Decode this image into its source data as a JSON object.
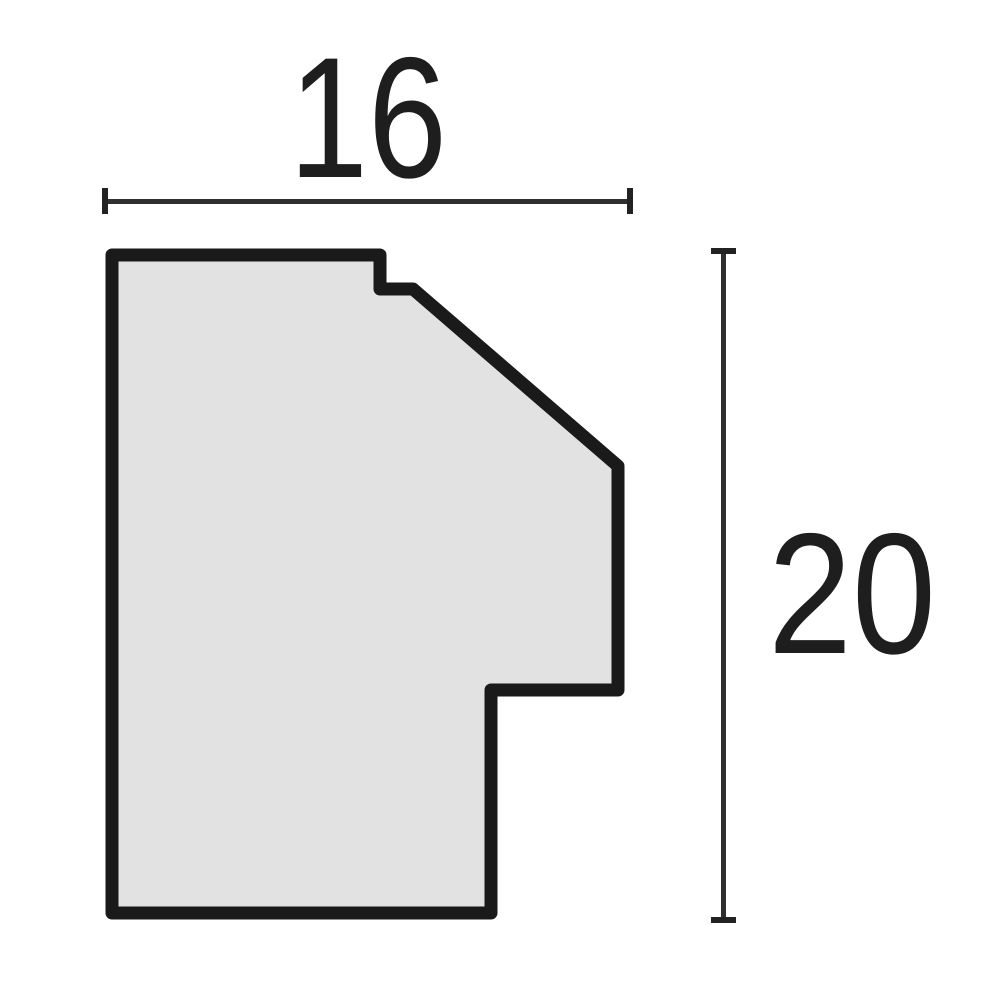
{
  "diagram": {
    "description": "Cross-section profile drawing of a picture-frame moulding with two dimension lines",
    "profile": {
      "outline_points": "112,255 380,255 380,289 413,289 618,466 618,690 491,690 491,913 112,913",
      "fill_color": "#e2e2e2",
      "stroke_color": "#1a1a1a",
      "stroke_width": 13
    },
    "dimensions": {
      "width": {
        "label": "16",
        "orientation": "horizontal",
        "line": {
          "x1": 104,
          "x2": 631,
          "y": 201
        }
      },
      "height": {
        "label": "20",
        "orientation": "vertical",
        "line": {
          "x": 723,
          "y1": 250,
          "y2": 921
        }
      }
    },
    "colors": {
      "background": "#ffffff",
      "dimension_line": "#2f2f2f",
      "dimension_tick": "#222222",
      "label_text": "#1e1e1e"
    }
  }
}
